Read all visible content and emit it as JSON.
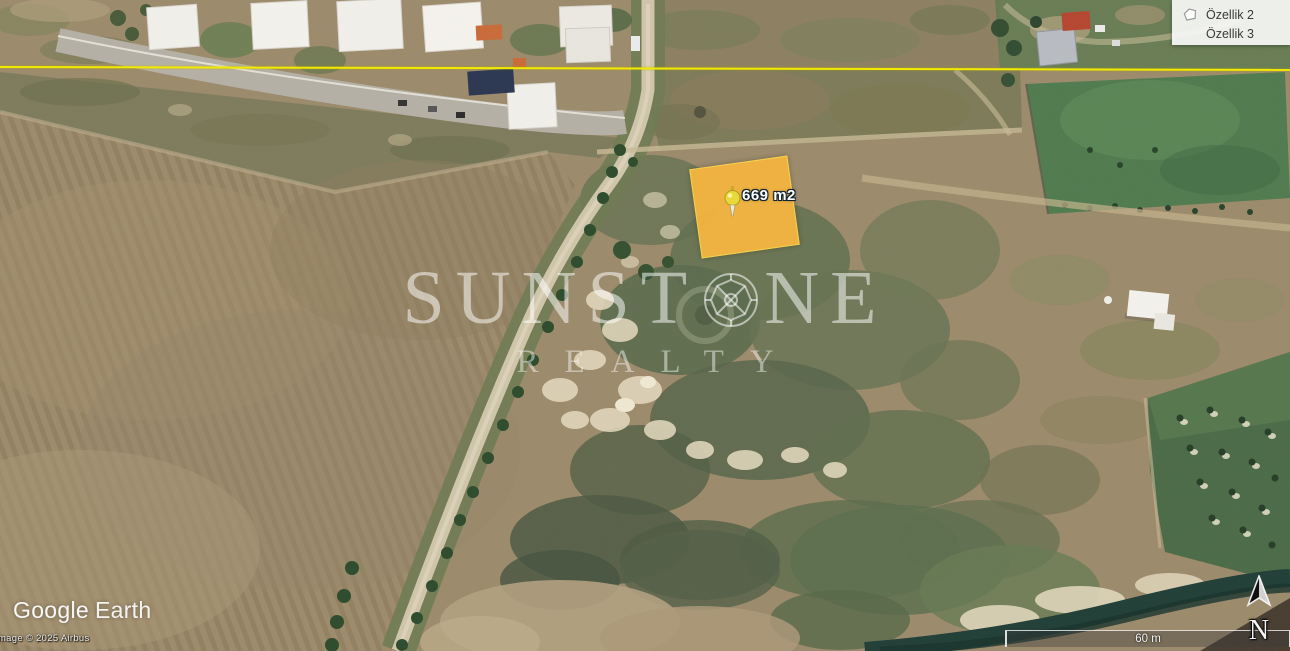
{
  "app": {
    "name": "Google Earth"
  },
  "legend": {
    "items": [
      {
        "label": "Özellik 2",
        "icon": "polygon-icon"
      },
      {
        "label": "Özellik 3",
        "icon": null
      }
    ]
  },
  "parcel": {
    "label": "669 m2",
    "pin": "yellow-pushpin-icon"
  },
  "watermark": {
    "part1": "SUNST",
    "part2": "NE",
    "gem": "gem-icon",
    "line2": "REALTY"
  },
  "branding": {
    "logo_part1": "Google",
    "logo_part2": "Earth",
    "copyright": "Image © 2025 Airbus"
  },
  "map_controls": {
    "scale_label": "60 m",
    "north_label": "N"
  },
  "colors": {
    "parcel_fill": "#F2B441",
    "parcel_border": "#F7D64C",
    "survey_line": "#F2EA00",
    "pin_yellow": "#E8D83A"
  }
}
